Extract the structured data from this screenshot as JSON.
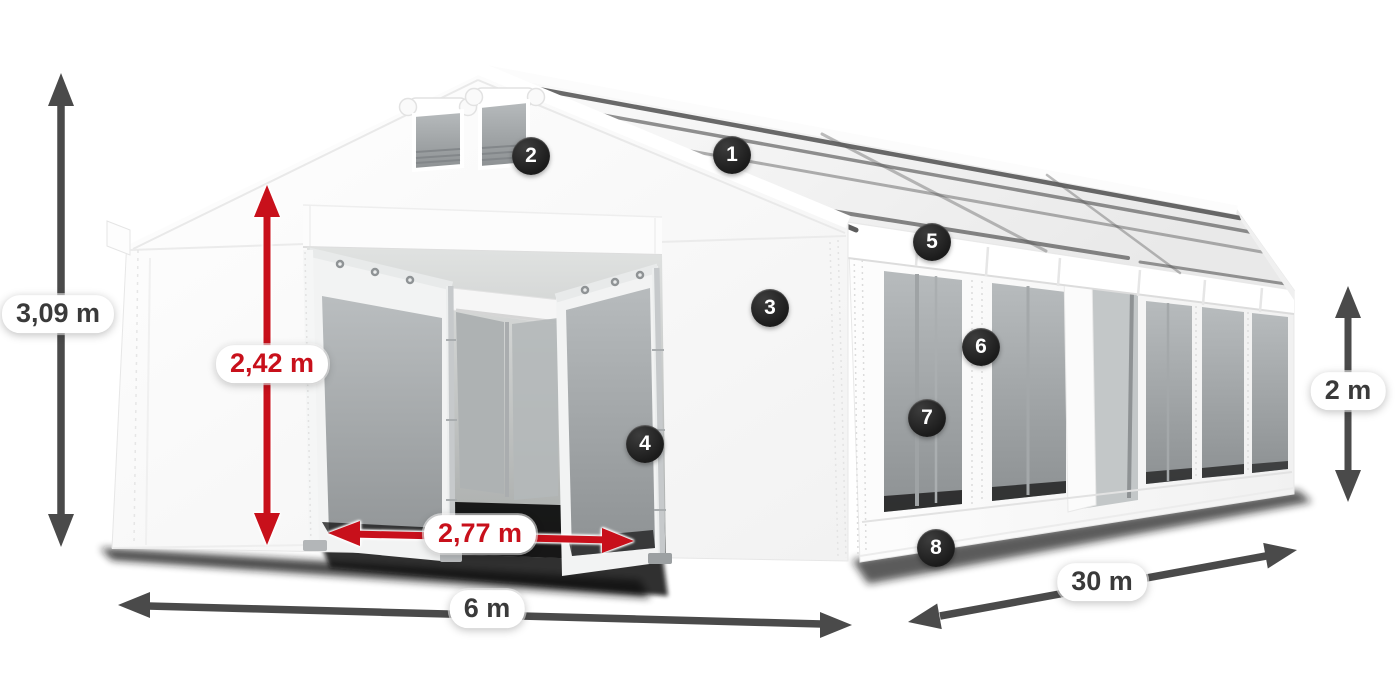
{
  "page": {
    "background": "#ffffff"
  },
  "dimensions": {
    "total_height": "3,09 m",
    "door_height": "2,42 m",
    "door_width": "2,77 m",
    "width": "6 m",
    "length": "30 m",
    "side_height": "2 m"
  },
  "callouts": {
    "c1": "1",
    "c2": "2",
    "c3": "3",
    "c4": "4",
    "c5": "5",
    "c6": "6",
    "c7": "7",
    "c8": "8"
  },
  "colors": {
    "dimension_red": "#c8101b",
    "dimension_dark": "#4a4a4a",
    "label_text_dark": "#3a3a3a",
    "badge_background": "#1f1f1f",
    "badge_text": "#ffffff",
    "tent_white": "#ffffff",
    "window_grey": "#a9adaf"
  }
}
